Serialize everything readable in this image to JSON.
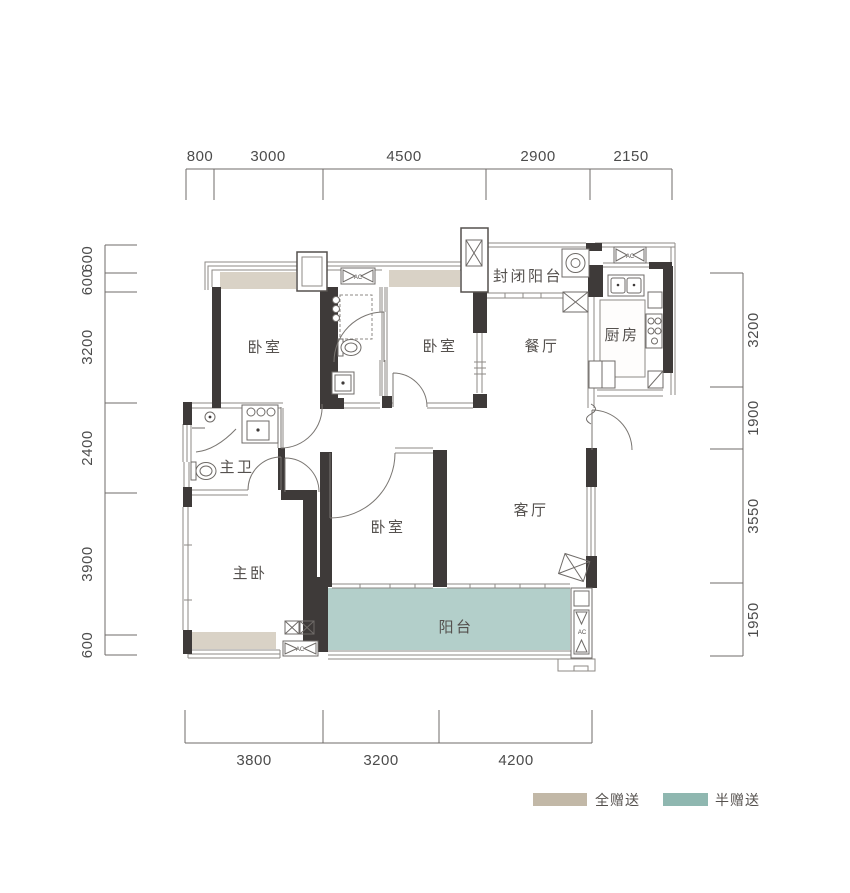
{
  "rooms": {
    "bedroom_top_left": "卧室",
    "bedroom_top_mid": "卧室",
    "bedroom_mid": "卧室",
    "enclosed_balcony": "封闭阳台",
    "dining": "餐厅",
    "kitchen": "厨房",
    "master_bath": "主卫",
    "master_bedroom": "主卧",
    "living": "客厅",
    "balcony": "阳台"
  },
  "dimensions": {
    "top": [
      "800",
      "3000",
      "4500",
      "2900",
      "2150"
    ],
    "left": [
      "600",
      "600",
      "3200",
      "2400",
      "3900",
      "600"
    ],
    "right": [
      "3200",
      "1900",
      "3550",
      "1950"
    ],
    "bottom": [
      "3800",
      "3200",
      "4200"
    ]
  },
  "legend": {
    "full": {
      "label": "全赠送",
      "color": "#c2b8a7"
    },
    "half": {
      "label": "半赠送",
      "color": "#8fb7b0"
    }
  },
  "areas": {
    "full_gift_color": "#d9d2c6",
    "half_gift_color": "#b3cfca"
  },
  "ac_label": "AC"
}
